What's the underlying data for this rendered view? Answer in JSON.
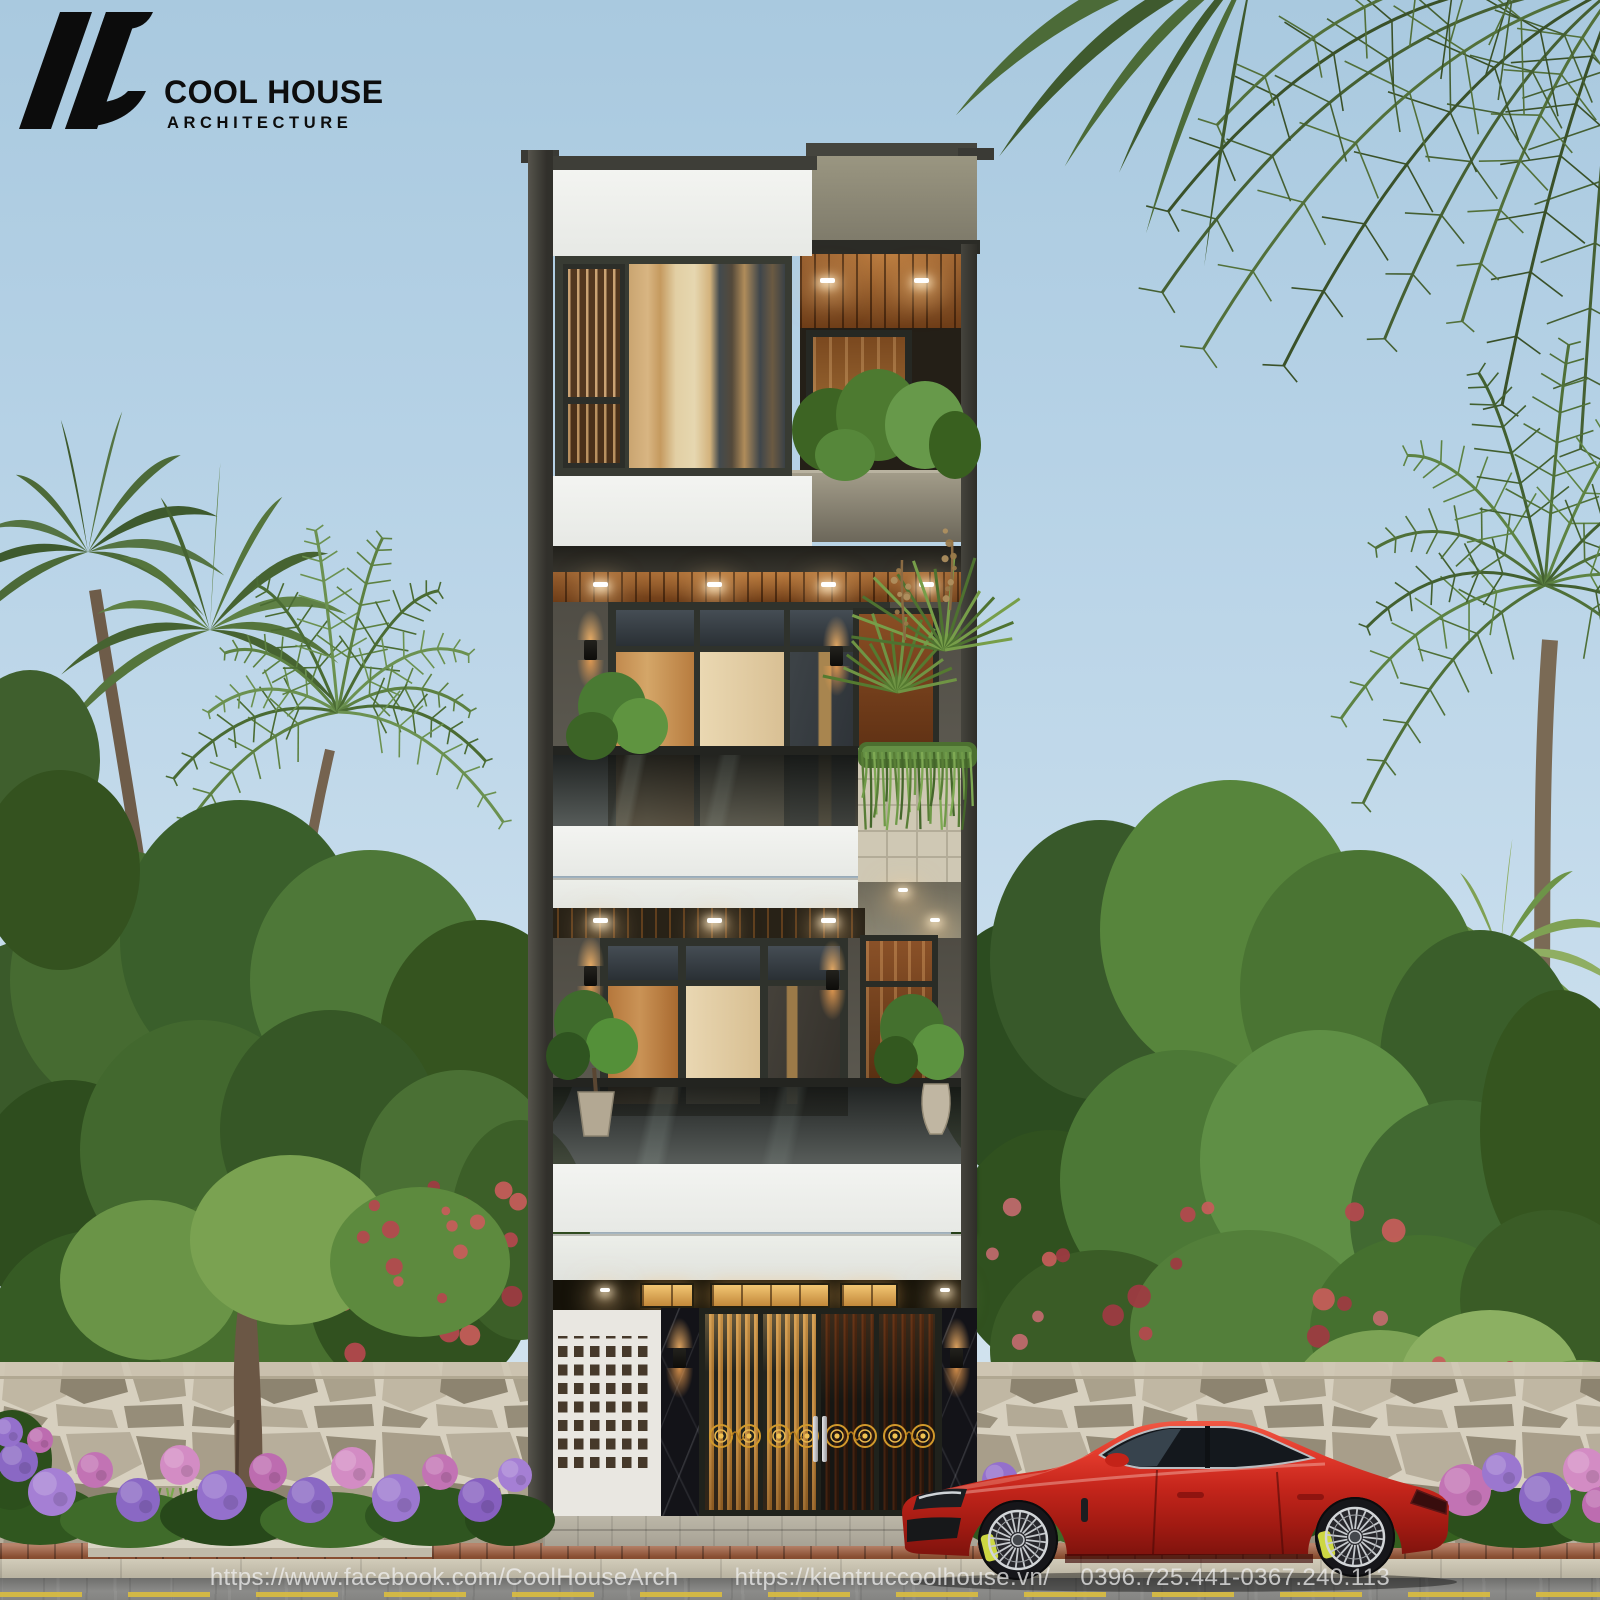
{
  "brand": {
    "name": "COOL HOUSE",
    "tagline": "ARCHITECTURE"
  },
  "watermark": {
    "facebook_url": "https://www.facebook.com/CoolHouseArch",
    "website_url": "https://kientruccoolhouse.vn/",
    "phone_numbers": "0396.725.441-0367.240.113"
  },
  "palette": {
    "sky": "#b6d2e6",
    "building_dark_trim": "#35342e",
    "building_taupe": "#8d897a",
    "panel_white": "#f0f1ee",
    "wood_soffit": "#8a5426",
    "warm_light": "#f0a85a",
    "gate_gold": "#d1992b",
    "marble_black": "#131318",
    "car_red": "#c4251b",
    "foliage_green": "#4a7434",
    "flower_purple": "#9470cc",
    "flower_pink": "#c273b4",
    "stone_mortar": "#d7d0bf",
    "brick_sidewalk": "#a05b3a",
    "road_gray": "#858583"
  }
}
